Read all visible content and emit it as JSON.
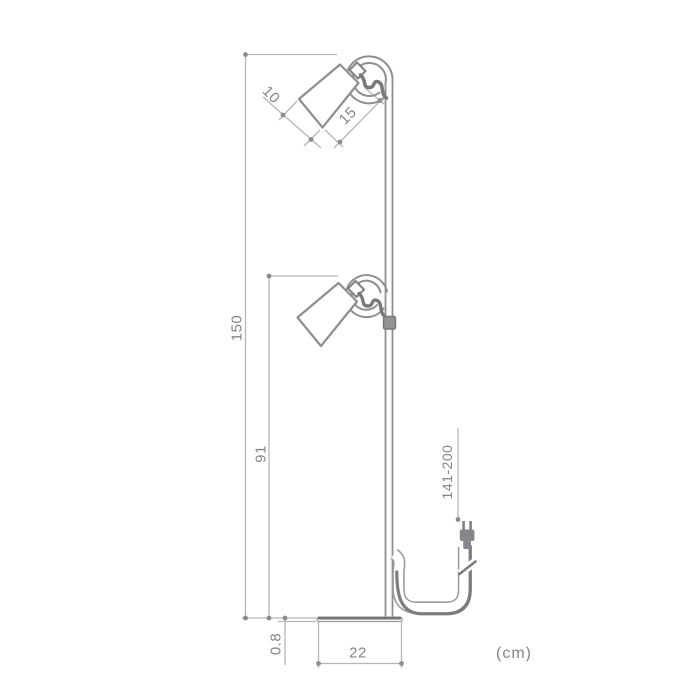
{
  "diagram": {
    "type": "dimension-line-drawing",
    "subject": "floor lamp with two adjustable cylindrical spot shades, hooked pole top, flat round base and power cord with plug",
    "unit_note": "(cm)",
    "dims": {
      "shade_diameter": "10",
      "shade_length": "15",
      "total_height": "150",
      "lower_lamp_height": "91",
      "cord_length": "141-200",
      "base_thickness": "0.8",
      "base_width": "22"
    },
    "colors": {
      "background": "#ffffff",
      "dimension_line": "#b6b6b6",
      "dimension_text": "#858585",
      "lamp_outline": "#8d8f91",
      "dark_detail": "#7b7d7f"
    }
  }
}
